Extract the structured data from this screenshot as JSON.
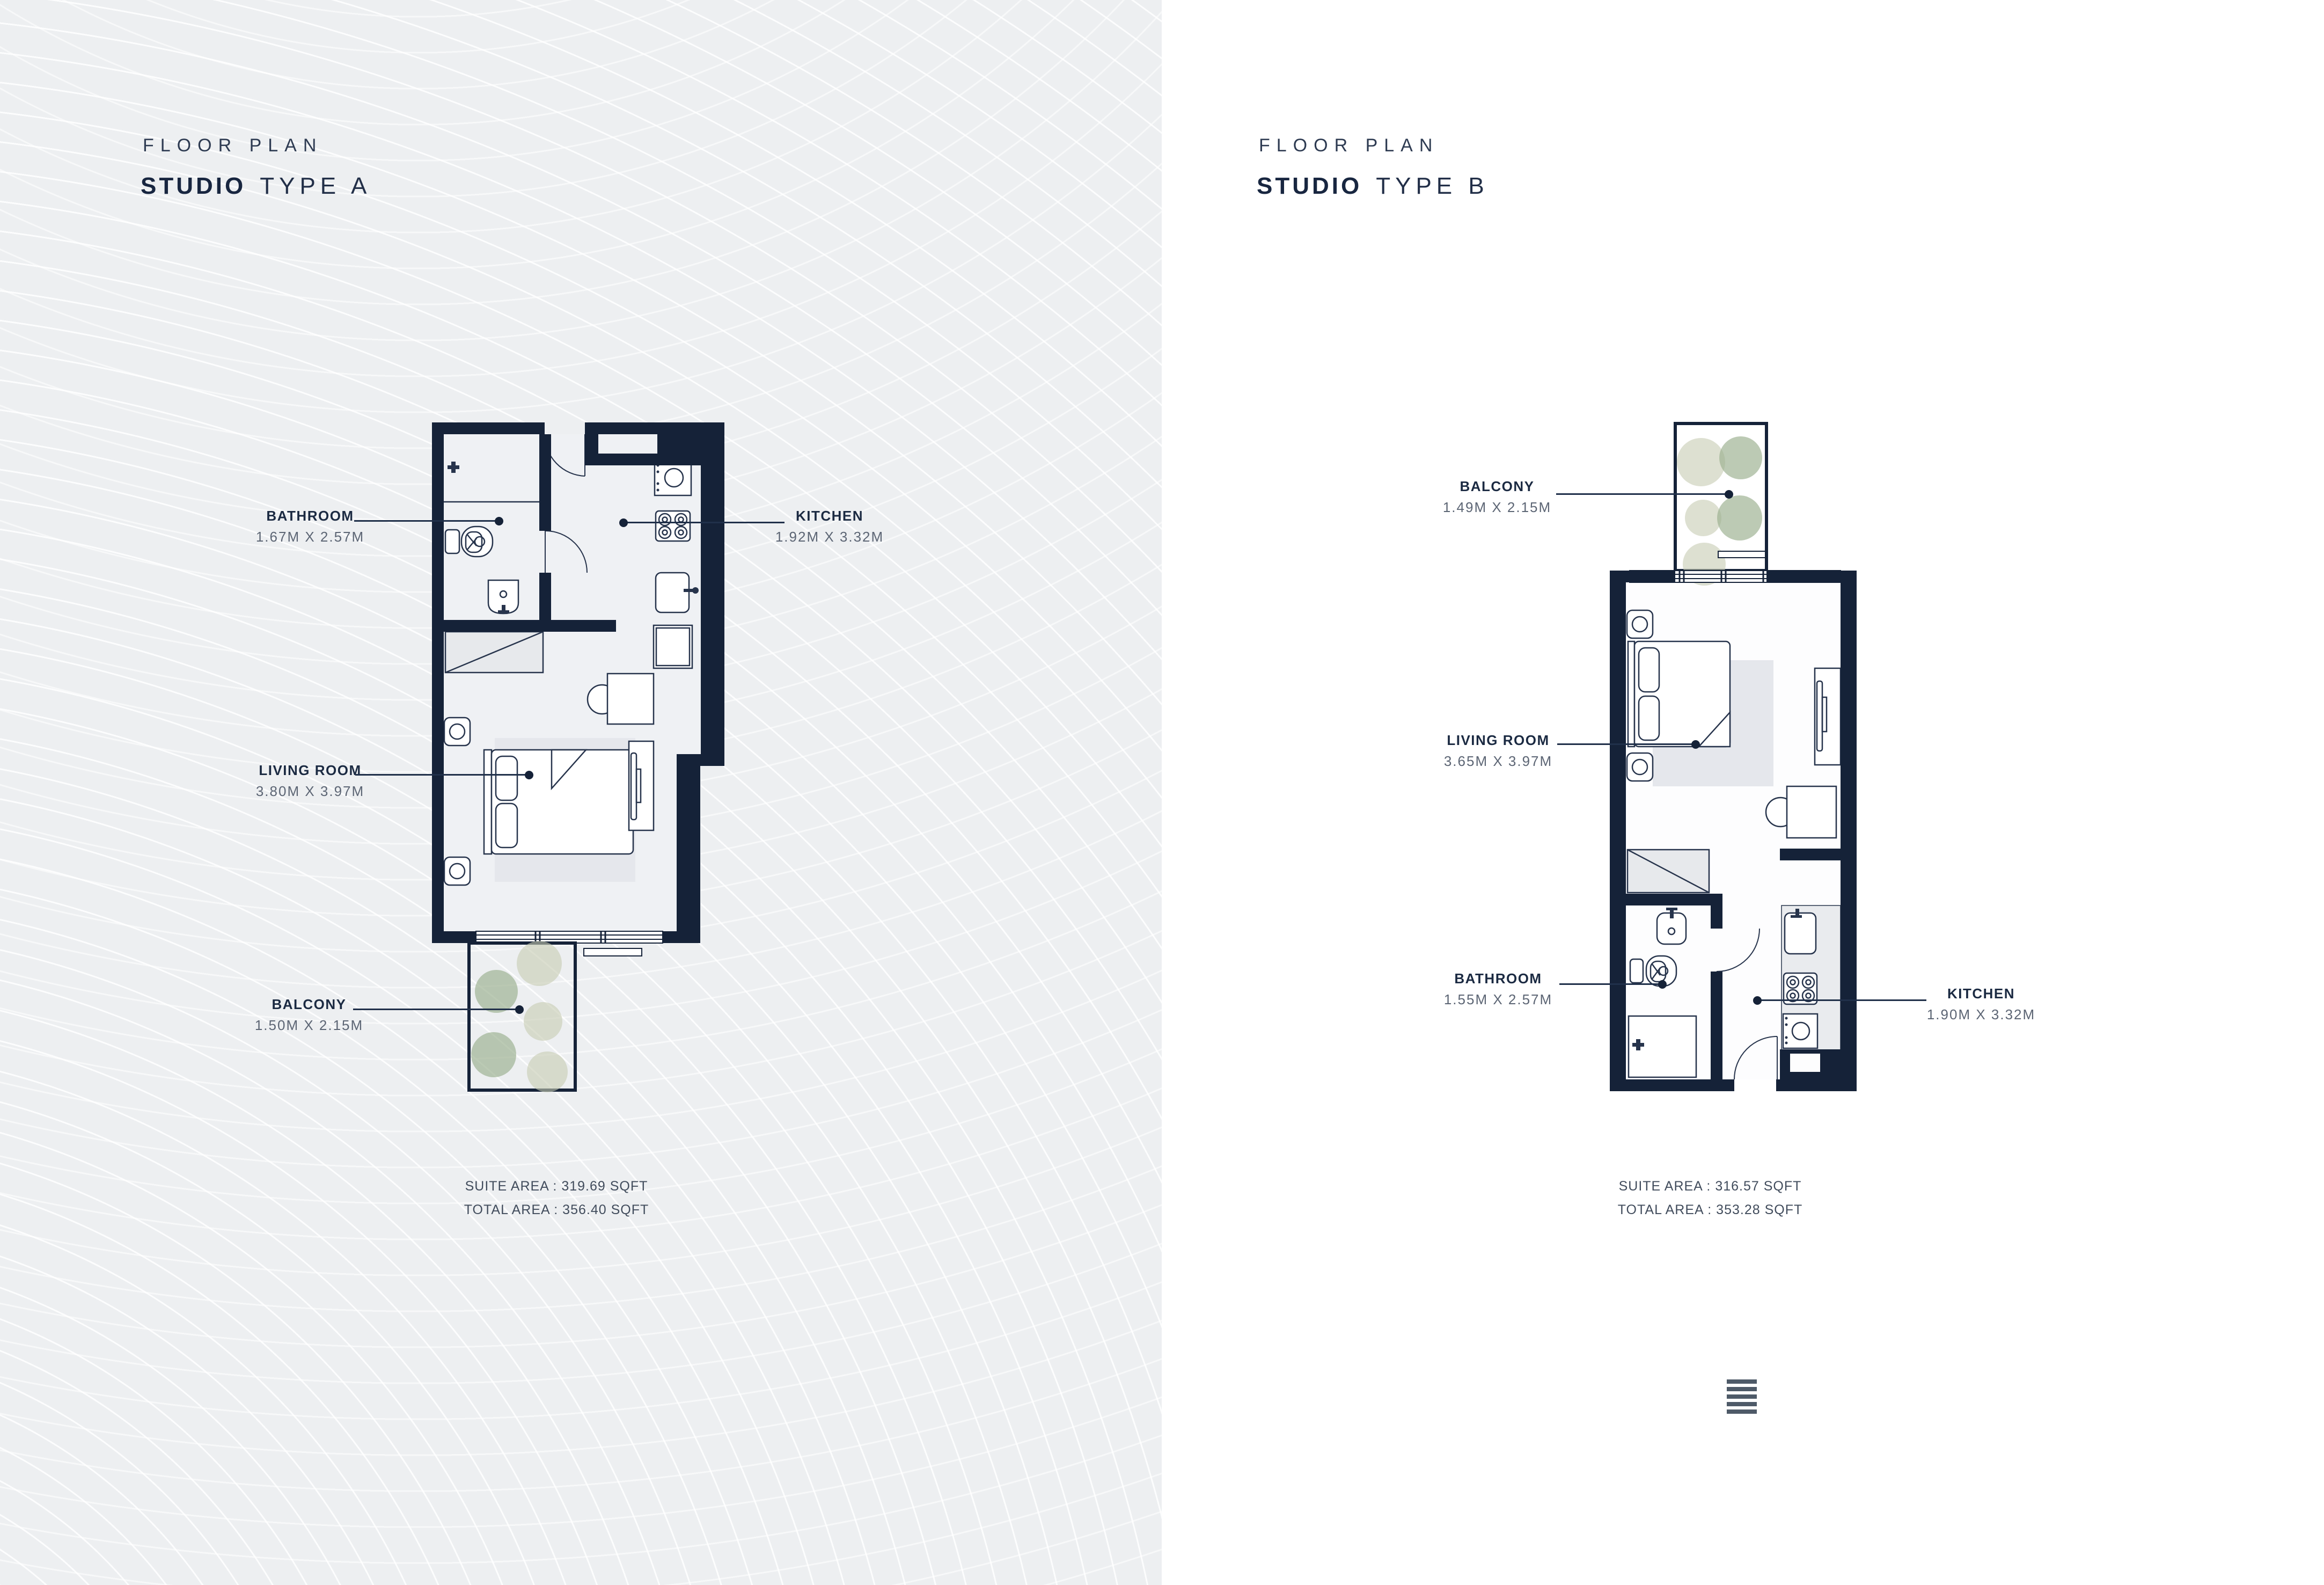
{
  "theme": {
    "left_bg": "#edeff1",
    "right_bg": "#ffffff",
    "wall_color": "#152238",
    "ink": "#1b2a42",
    "dim_ink": "#5c6574",
    "leader_color": "#20304a",
    "plant_green": "#9cb191",
    "plant_olive": "#c6ccb2",
    "icon_slate": "#4e5a68"
  },
  "plans": [
    {
      "eyebrow": "FLOOR PLAN",
      "title_bold": "STUDIO",
      "title_light": "TYPE A",
      "labels": [
        {
          "name": "BATHROOM",
          "dims": "1.67M X 2.57M"
        },
        {
          "name": "KITCHEN",
          "dims": "1.92M X 3.32M"
        },
        {
          "name": "LIVING ROOM",
          "dims": "3.80M X 3.97M"
        },
        {
          "name": "BALCONY",
          "dims": "1.50M X 2.15M"
        }
      ],
      "suite_area": "SUITE AREA : 319.69 SQFT",
      "total_area": "TOTAL AREA : 356.40 SQFT"
    },
    {
      "eyebrow": "FLOOR PLAN",
      "title_bold": "STUDIO",
      "title_light": "TYPE B",
      "labels": [
        {
          "name": "BALCONY",
          "dims": "1.49M X 2.15M"
        },
        {
          "name": "LIVING ROOM",
          "dims": "3.65M X 3.97M"
        },
        {
          "name": "BATHROOM",
          "dims": "1.55M X 2.57M"
        },
        {
          "name": "KITCHEN",
          "dims": "1.90M X 3.32M"
        }
      ],
      "suite_area": "SUITE AREA : 316.57 SQFT",
      "total_area": "TOTAL AREA : 353.28 SQFT"
    }
  ],
  "footer_icon": "stacked-bars-icon"
}
